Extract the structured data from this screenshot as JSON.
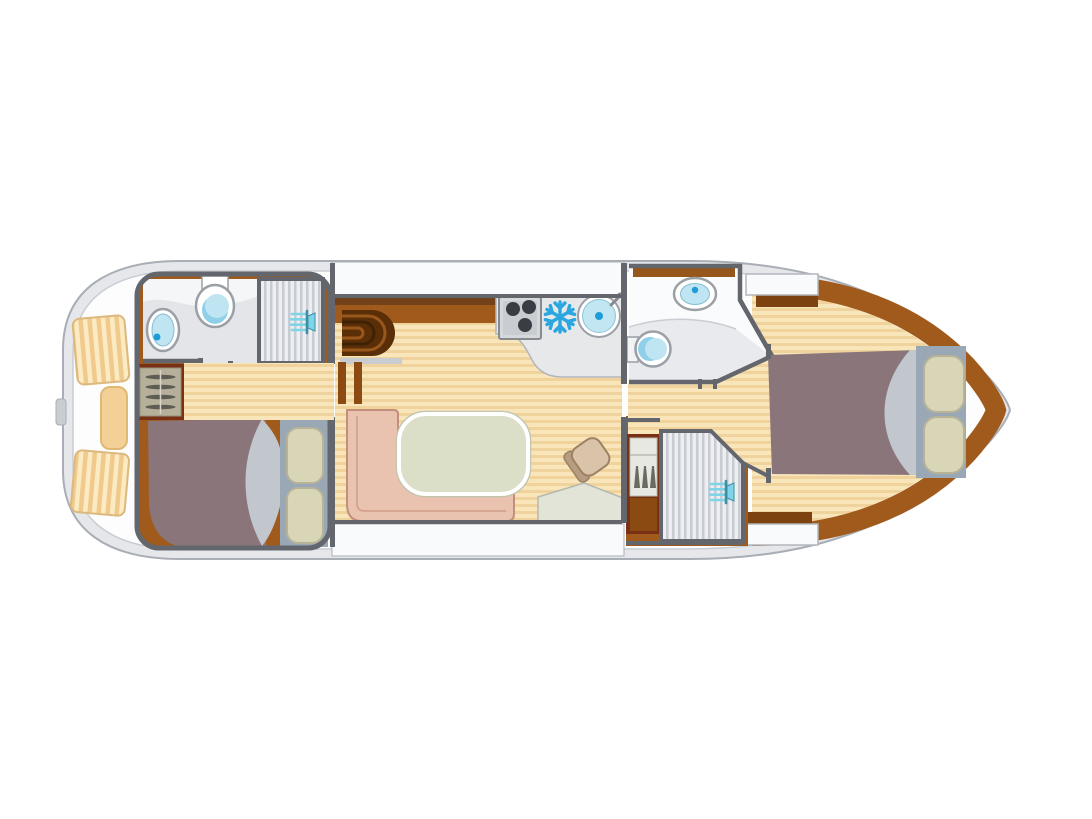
{
  "canvas": {
    "width": 1092,
    "height": 819
  },
  "colors": {
    "canvas_bg": "#ffffff",
    "hull_fill": "#e5e7ea",
    "hull_edge": "#a9aeb6",
    "deck_white": "#fdfdfe",
    "deck_line": "#c9cdd2",
    "walk_white": "#f9fafb",
    "wall": "#63676d",
    "wood_base": "#f8e5ba",
    "wood_stripe": "#efd29c",
    "trim": "#a05a1c",
    "trim_dark": "#7c4210",
    "trim_deep": "#5a2f08",
    "maroon": "#7a3015",
    "bed_blanket": "#8a757b",
    "bed_sheet": "#c2c6cd",
    "pillow": "#d9d5b7",
    "pillow_edge": "#b7b399",
    "headboard": "#9aa8b6",
    "sofa": "#eac2b0",
    "sofa_edge": "#c2907a",
    "table": "#dcdfc8",
    "table_ring": "#c2c5ad",
    "counter": "#e6e8ea",
    "counter_edge": "#b2b6bc",
    "room_white": "#fafbfc",
    "room_gray": "#e8eaed",
    "fixture_rim": "#9aa0a6",
    "water": "#bfe5f2",
    "water_deep": "#8fd0e8",
    "water_dot": "#1f9cd7",
    "steel": "#d6d9dc",
    "steel_edge": "#878b90",
    "burner": "#3a3e44",
    "snowflake": "#2aa6e0",
    "shower_base": "#edeef1",
    "shower_stripe": "#c7cbd2",
    "shower_teal": "#7fd4e8",
    "shower_teal_dark": "#3e8fa3",
    "wardrobe": "#b6af99",
    "louvre": "#5d5d55",
    "locker": "#e7e8e1",
    "seat_tan": "#f3d096",
    "seat_edge": "#dfb874",
    "console": "#e2e4d8",
    "chair": "#d9c3a9",
    "chair_back": "#b89c80",
    "chair_edge": "#9c8264",
    "mat_base": "#fbeac2",
    "mat_stripe": "#f0c98c",
    "mat_edge": "#dcb97e"
  },
  "icons": [
    {
      "name": "stove-burners-icon",
      "shape": "square with 3 dark burner circles"
    },
    {
      "name": "snowflake-fridge-icon",
      "shape": "6-spoke snowflake"
    },
    {
      "name": "galley-sink-icon",
      "shape": "round basin with faucet"
    },
    {
      "name": "washbasin-icon-aft",
      "shape": "oval basin with drain dot"
    },
    {
      "name": "washbasin-icon-bow",
      "shape": "oval basin with drain dot"
    },
    {
      "name": "toilet-icon-aft",
      "shape": "bowl circle with tank"
    },
    {
      "name": "toilet-icon-bow",
      "shape": "bowl circle with tank"
    },
    {
      "name": "shower-head-icon-aft",
      "shape": "spray fan with head"
    },
    {
      "name": "shower-head-icon-mid",
      "shape": "spray fan with head"
    },
    {
      "name": "companionway-stairs-icon",
      "shape": "nested wooden arcs"
    },
    {
      "name": "wardrobe-louvre-icon",
      "shape": "slatted shelves"
    },
    {
      "name": "bottle-rack-icon",
      "shape": "three bottles on shelf"
    }
  ]
}
